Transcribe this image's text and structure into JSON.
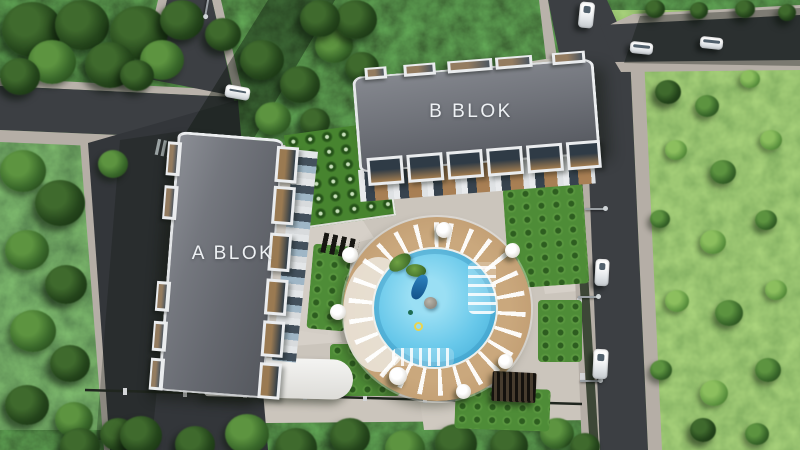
{
  "scene": {
    "title": "Aerial 3D site plan of a residential complex",
    "buildings": [
      {
        "id": "a",
        "label": "A BLOK"
      },
      {
        "id": "b",
        "label": "B BLOK"
      }
    ],
    "amenities": {
      "pool": "circular swimming pool with sun deck",
      "pergola": "poolside pergola",
      "garden": "landscaped garden"
    },
    "colors": {
      "roof_gray": "#6e7178",
      "pool_water": "#5ec4e8",
      "deck_wood": "#c9a47a",
      "grass_light": "#6aa04c",
      "forest_dark": "#2c4a23",
      "asphalt": "#3c3f43",
      "sidewalk": "#b5aea6",
      "label_text": "#eef1f4",
      "car_white": "#f4f5f6"
    }
  }
}
